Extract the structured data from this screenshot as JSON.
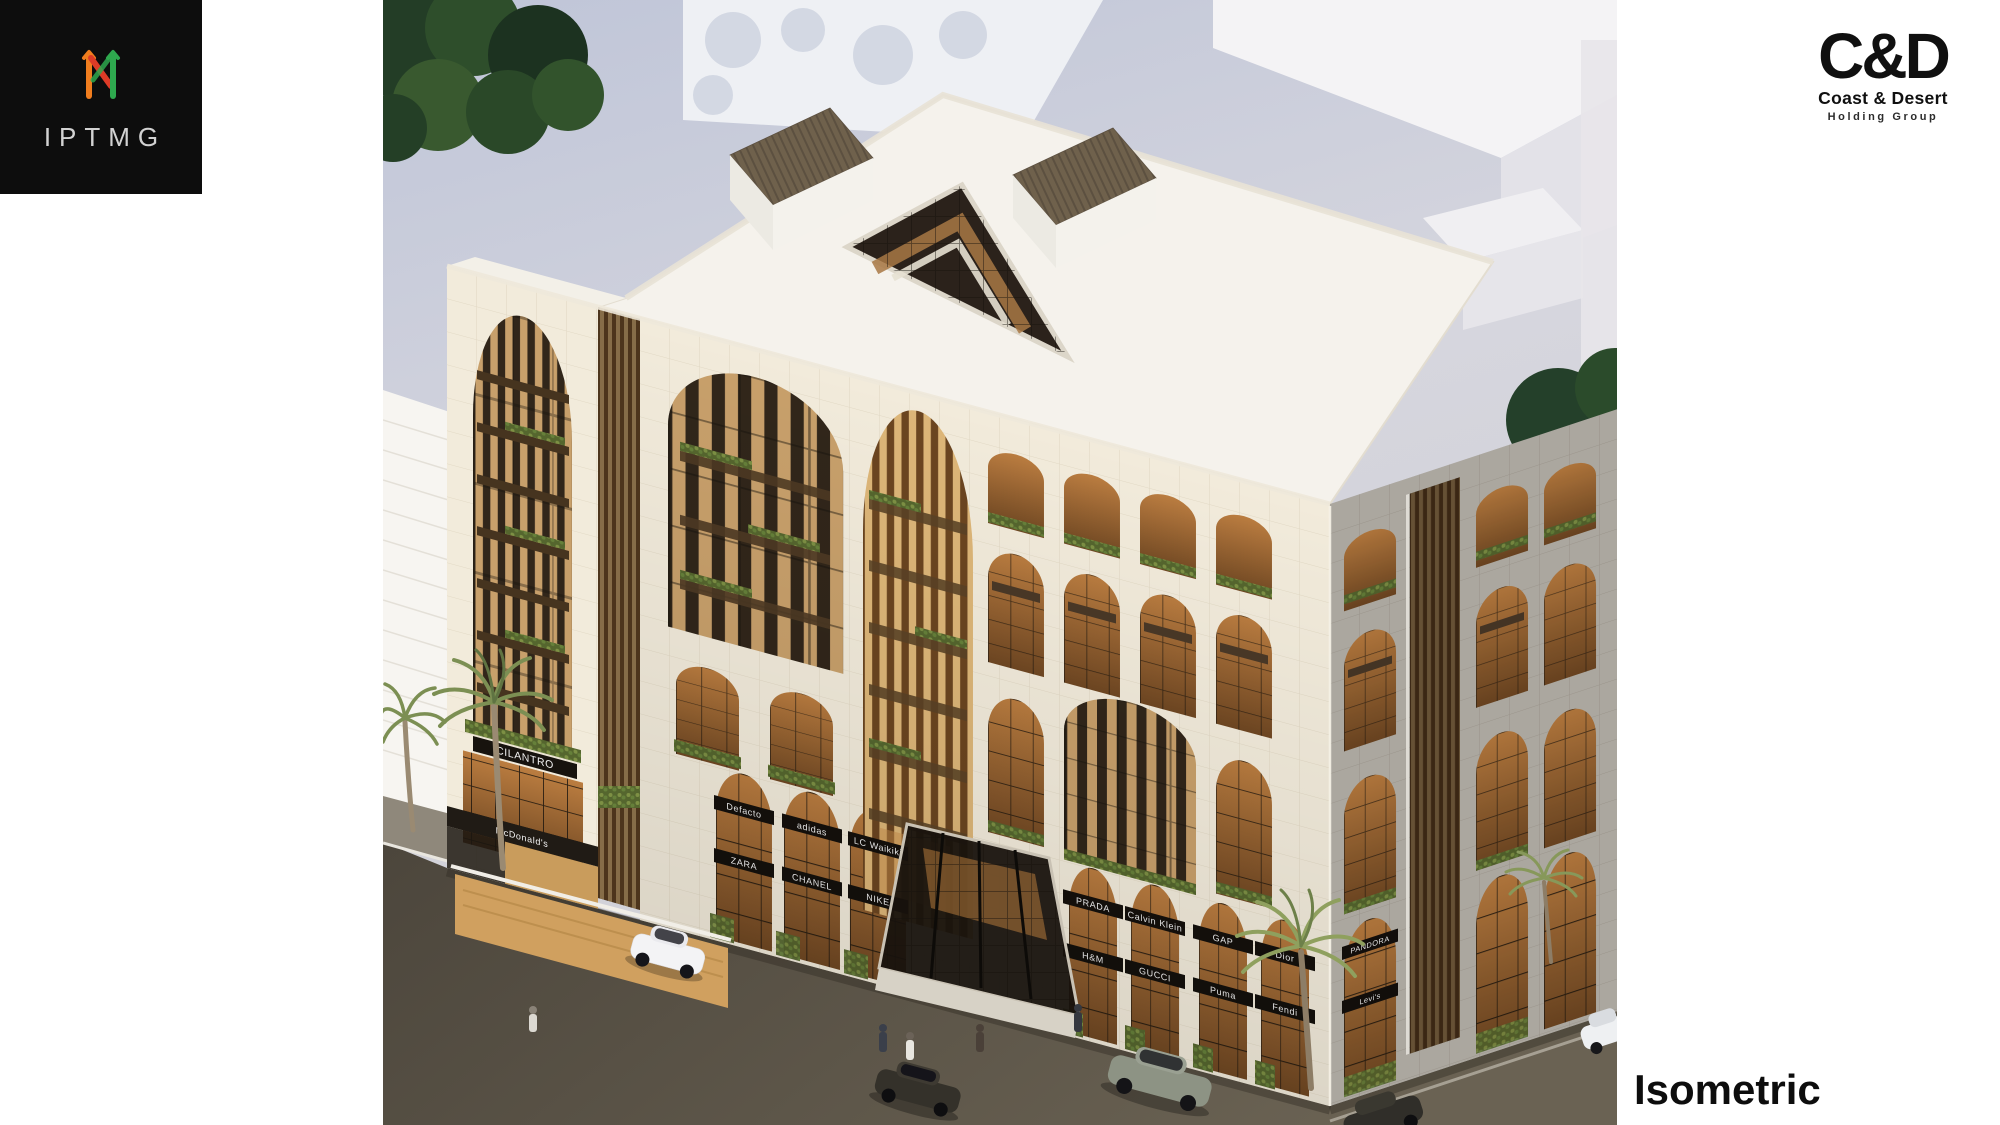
{
  "slide": {
    "background": "#ffffff"
  },
  "logos": {
    "iptmg": {
      "text": "IPTMG",
      "box_color": "#0d0d0d",
      "text_color": "#d2d2d2",
      "icon": "iptmg-arrows-monogram",
      "icon_colors": {
        "orange": "#f07d1e",
        "red": "#dd3b27",
        "green": "#2ea84e"
      }
    },
    "coast_desert": {
      "initials": "C&D",
      "name": "Coast & Desert",
      "subtitle": "Holding Group",
      "color": "#101010"
    }
  },
  "caption": {
    "label": "Isometric",
    "color": "#0d0d0d"
  },
  "rendering": {
    "palette": {
      "facade_cream": "#f1ead9",
      "facade_gray": "#b8b3ab",
      "wood_louver": "#c8a06b",
      "warm_glass": "#a06b36",
      "greenery": "#5f7036",
      "street": "#564f42",
      "ground": "#cdd1de",
      "roof": "#f6f3ee"
    },
    "storefront_signs": [
      {
        "label": "CILANTRO"
      },
      {
        "label": "McDonald's"
      },
      {
        "label": "Defacto"
      },
      {
        "label": "ZARA"
      },
      {
        "label": "adidas"
      },
      {
        "label": "CHANEL"
      },
      {
        "label": "LC Waikiki"
      },
      {
        "label": "NIKE"
      },
      {
        "label": "PRADA"
      },
      {
        "label": "H&M"
      },
      {
        "label": "Calvin Klein"
      },
      {
        "label": "GUCCI"
      },
      {
        "label": "GAP"
      },
      {
        "label": "Puma"
      },
      {
        "label": "Dior"
      },
      {
        "label": "Fendi"
      },
      {
        "label": "PANDORA"
      },
      {
        "label": "Levi's"
      }
    ]
  }
}
